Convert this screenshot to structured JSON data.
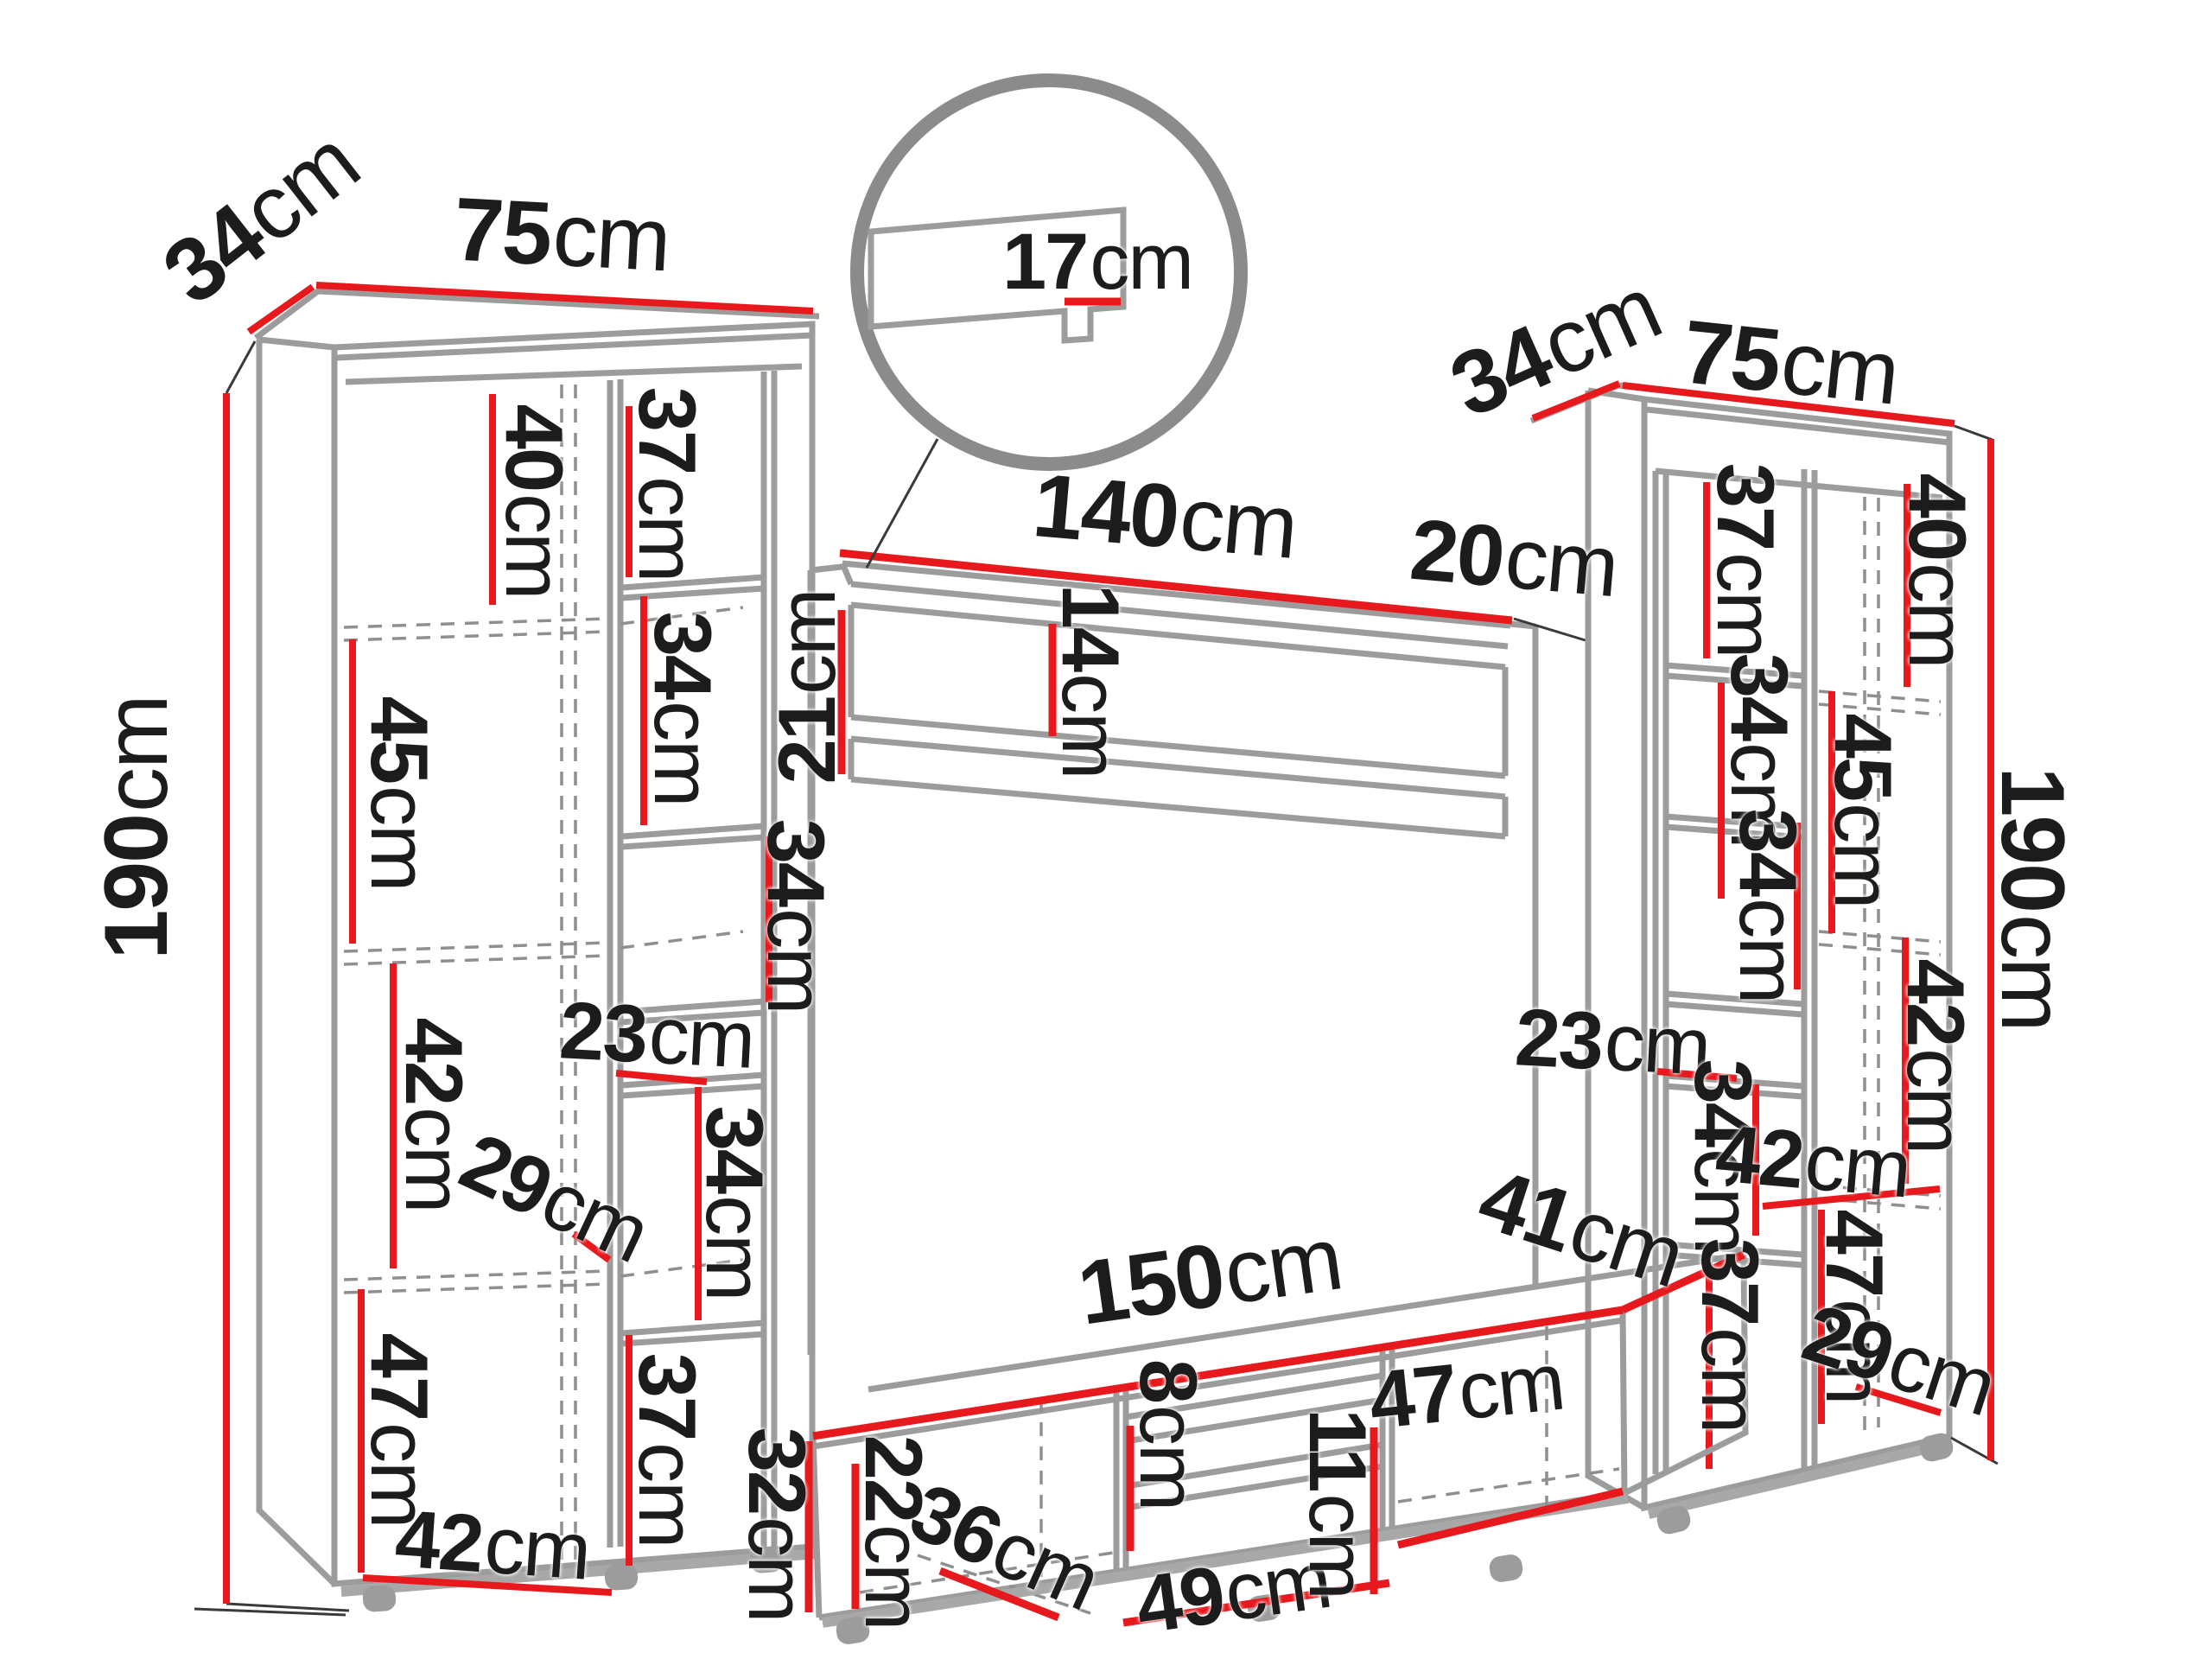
{
  "figure": "wall-unit furniture dimension diagram",
  "palette": {
    "red": "#e8191d",
    "gray": "#9c9c9c",
    "dash_gray": "#8f8f8f",
    "circle_gray": "#8b8b8b",
    "text": "#1c1c1c"
  },
  "dims": {
    "l_depth": {
      "v": "34",
      "u": "cm"
    },
    "l_width": {
      "v": "75",
      "u": "cm"
    },
    "l_height": {
      "v": "190",
      "u": "cm"
    },
    "l_s40": {
      "v": "40",
      "u": "cm"
    },
    "l_s45": {
      "v": "45",
      "u": "cm"
    },
    "l_s42": {
      "v": "42",
      "u": "cm"
    },
    "l_s47": {
      "v": "47",
      "u": "cm"
    },
    "l_door42": {
      "v": "42",
      "u": "cm"
    },
    "l_d29": {
      "v": "29",
      "u": "cm"
    },
    "l_n37t": {
      "v": "37",
      "u": "cm"
    },
    "l_n34a": {
      "v": "34",
      "u": "cm"
    },
    "l_n34e": {
      "v": "34",
      "u": "cm"
    },
    "l_n23": {
      "v": "23",
      "u": "cm"
    },
    "l_n34b": {
      "v": "34",
      "u": "cm"
    },
    "l_n37b": {
      "v": "37",
      "u": "cm"
    },
    "sh_140": {
      "v": "140",
      "u": "cm"
    },
    "sh_20": {
      "v": "20",
      "u": "cm"
    },
    "sh_21": {
      "v": "21",
      "u": "cm"
    },
    "sh_14": {
      "v": "14",
      "u": "cm"
    },
    "detail_17": {
      "v": "17",
      "u": "cm"
    },
    "tv_150": {
      "v": "150",
      "u": "cm"
    },
    "tv_41": {
      "v": "41",
      "u": "cm"
    },
    "tv_32": {
      "v": "32",
      "u": "cm"
    },
    "tv_22": {
      "v": "22",
      "u": "cm"
    },
    "tv_36": {
      "v": "36",
      "u": "cm"
    },
    "tv_8": {
      "v": "8",
      "u": "cm"
    },
    "tv_49": {
      "v": "49",
      "u": "cm"
    },
    "tv_11": {
      "v": "11",
      "u": "cm"
    },
    "tv_47": {
      "v": "47",
      "u": "cm"
    },
    "r_depth": {
      "v": "34",
      "u": "cm"
    },
    "r_width": {
      "v": "75",
      "u": "cm"
    },
    "r_height": {
      "v": "190",
      "u": "cm"
    },
    "r_n37t": {
      "v": "37",
      "u": "cm"
    },
    "r_n34a": {
      "v": "34",
      "u": "cm"
    },
    "r_n34e": {
      "v": "34",
      "u": "cm"
    },
    "r_n23": {
      "v": "23",
      "u": "cm"
    },
    "r_n34b": {
      "v": "34",
      "u": "cm"
    },
    "r_n37b": {
      "v": "37",
      "u": "cm"
    },
    "r_s40": {
      "v": "40",
      "u": "cm"
    },
    "r_s45": {
      "v": "45",
      "u": "cm"
    },
    "r_s42": {
      "v": "42",
      "u": "cm"
    },
    "r_42w": {
      "v": "42",
      "u": "cm"
    },
    "r_s47": {
      "v": "47",
      "u": "cm"
    },
    "r_d29": {
      "v": "29",
      "u": "cm"
    }
  }
}
